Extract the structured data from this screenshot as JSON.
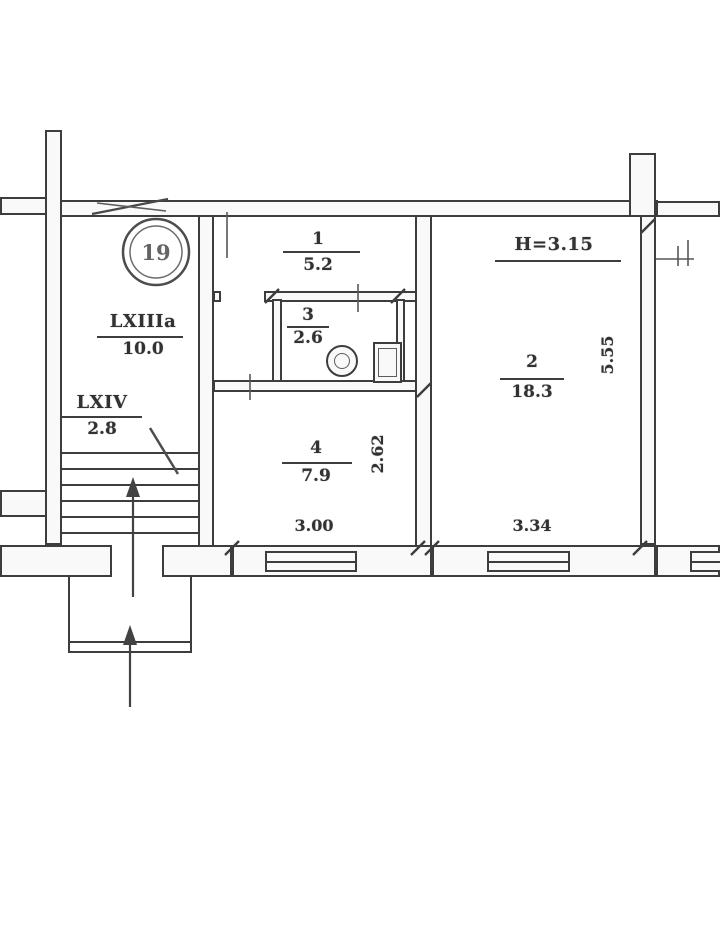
{
  "document": {
    "type": "apartment floor plan (scanned technical drawing)"
  },
  "rooms": [
    {
      "name": "stairwell",
      "number": "LXIIIa",
      "area": "10.0"
    },
    {
      "name": "stair-landing",
      "number": "LXIV",
      "area": "2.8"
    },
    {
      "name": "hallway",
      "number": "1",
      "area": "5.2"
    },
    {
      "name": "living-room",
      "number": "2",
      "area": "18.3"
    },
    {
      "name": "bathroom",
      "number": "3",
      "area": "2.6"
    },
    {
      "name": "kitchen",
      "number": "4",
      "area": "7.9"
    }
  ],
  "annotations": {
    "ceiling_height": "H=3.15"
  },
  "dimensions": {
    "kitchen_width": "3.00",
    "living_room_width": "3.34",
    "kitchen_depth": "2.62",
    "living_room_depth": "5.55"
  },
  "stamp": {
    "number": "19"
  },
  "colors": {
    "ink": "#3a3a3a",
    "paper": "#ffffff"
  }
}
